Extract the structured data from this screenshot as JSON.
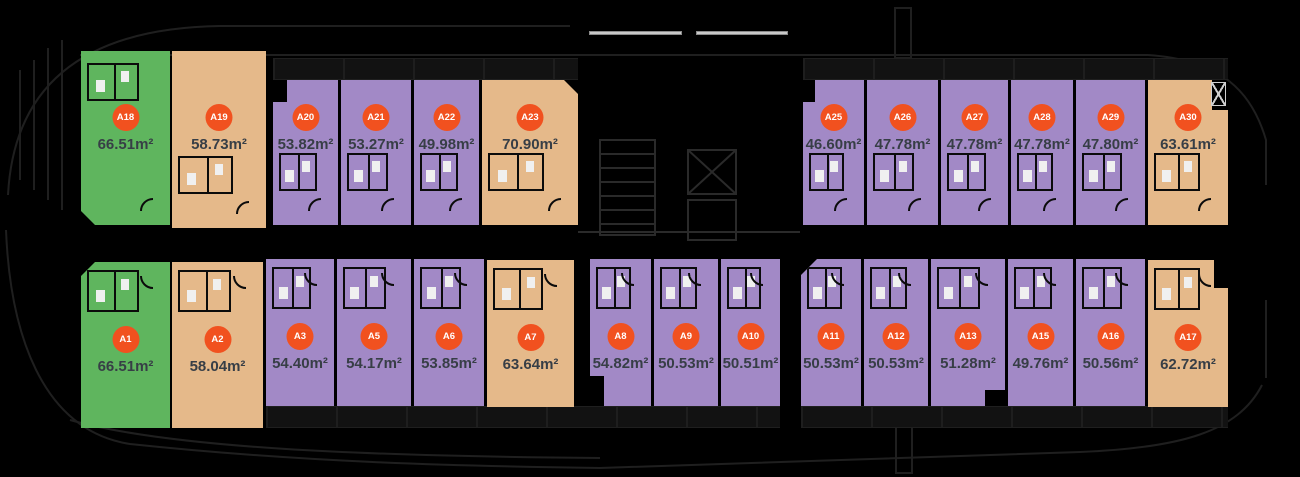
{
  "plan_title": "Apartment floor plan with unit areas",
  "colors": {
    "background": "#000000",
    "green": "#5fb55e",
    "tan": "#e5b98a",
    "purple": "#a289c6",
    "badge": "#f1511f",
    "badge_text": "#ffffff",
    "area_text": "#373e46",
    "light_line": "#c9c9c9",
    "outline_faint": "#1f1f1f"
  },
  "units": [
    {
      "id": "a18",
      "label": "A18",
      "area": "66.51m²",
      "color": "green"
    },
    {
      "id": "a19",
      "label": "A19",
      "area": "58.73m²",
      "color": "tan"
    },
    {
      "id": "a20",
      "label": "A20",
      "area": "53.82m²",
      "color": "purple"
    },
    {
      "id": "a21",
      "label": "A21",
      "area": "53.27m²",
      "color": "purple"
    },
    {
      "id": "a22",
      "label": "A22",
      "area": "49.98m²",
      "color": "purple"
    },
    {
      "id": "a23",
      "label": "A23",
      "area": "70.90m²",
      "color": "tan"
    },
    {
      "id": "a25",
      "label": "A25",
      "area": "46.60m²",
      "color": "purple"
    },
    {
      "id": "a26",
      "label": "A26",
      "area": "47.78m²",
      "color": "purple"
    },
    {
      "id": "a27",
      "label": "A27",
      "area": "47.78m²",
      "color": "purple"
    },
    {
      "id": "a28",
      "label": "A28",
      "area": "47.78m²",
      "color": "purple"
    },
    {
      "id": "a29",
      "label": "A29",
      "area": "47.80m²",
      "color": "purple"
    },
    {
      "id": "a30",
      "label": "A30",
      "area": "63.61m²",
      "color": "tan"
    },
    {
      "id": "a1",
      "label": "A1",
      "area": "66.51m²",
      "color": "green"
    },
    {
      "id": "a2",
      "label": "A2",
      "area": "58.04m²",
      "color": "tan"
    },
    {
      "id": "a3",
      "label": "A3",
      "area": "54.40m²",
      "color": "purple"
    },
    {
      "id": "a5",
      "label": "A5",
      "area": "54.17m²",
      "color": "purple"
    },
    {
      "id": "a6",
      "label": "A6",
      "area": "53.85m²",
      "color": "purple"
    },
    {
      "id": "a7",
      "label": "A7",
      "area": "63.64m²",
      "color": "tan"
    },
    {
      "id": "a8",
      "label": "A8",
      "area": "54.82m²",
      "color": "purple"
    },
    {
      "id": "a9",
      "label": "A9",
      "area": "50.53m²",
      "color": "purple"
    },
    {
      "id": "a10",
      "label": "A10",
      "area": "50.51m²",
      "color": "purple"
    },
    {
      "id": "a11",
      "label": "A11",
      "area": "50.53m²",
      "color": "purple"
    },
    {
      "id": "a12",
      "label": "A12",
      "area": "50.53m²",
      "color": "purple"
    },
    {
      "id": "a13",
      "label": "A13",
      "area": "51.28m²",
      "color": "purple"
    },
    {
      "id": "a15",
      "label": "A15",
      "area": "49.76m²",
      "color": "purple"
    },
    {
      "id": "a16",
      "label": "A16",
      "area": "50.56m²",
      "color": "purple"
    },
    {
      "id": "a17",
      "label": "A17",
      "area": "62.72m²",
      "color": "tan"
    }
  ]
}
